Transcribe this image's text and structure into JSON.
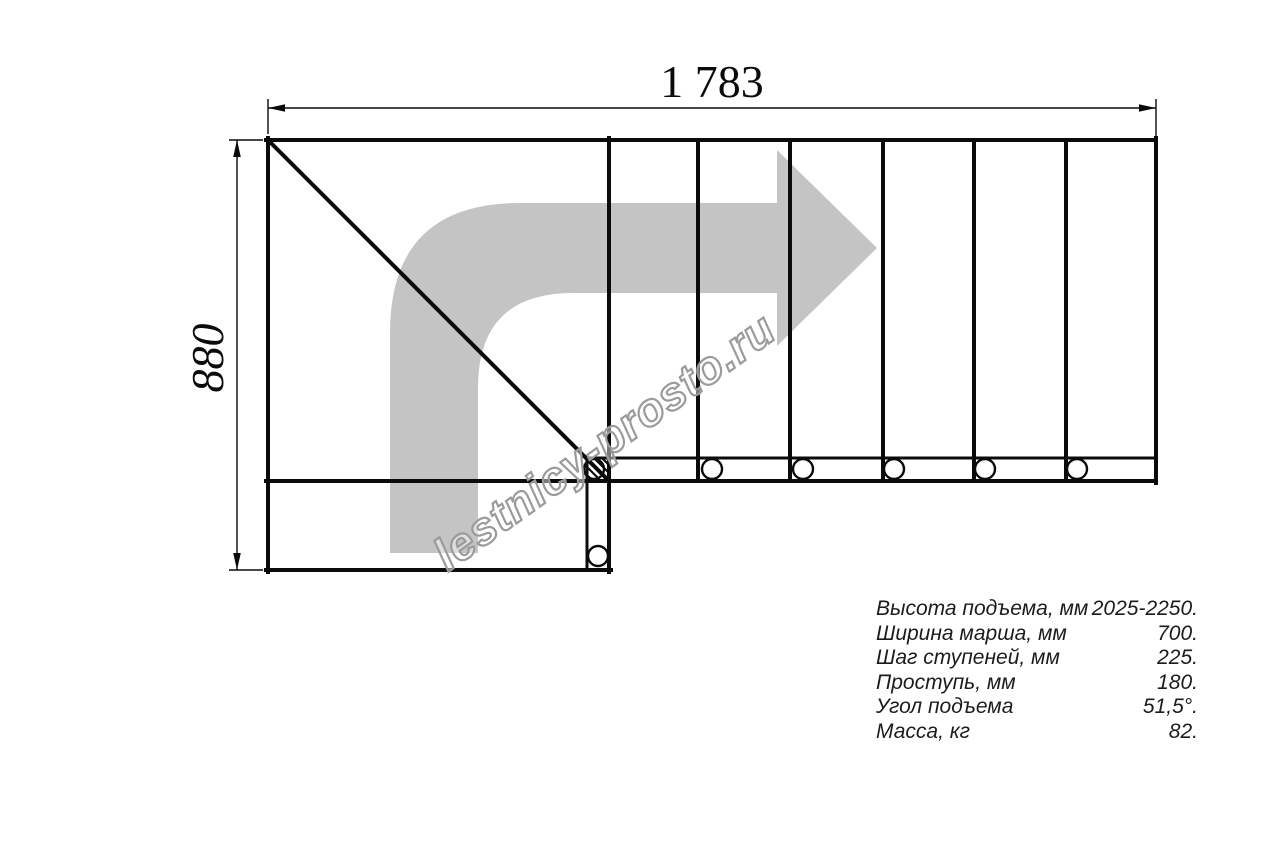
{
  "dimensions": {
    "width_label": "1 783",
    "height_label": "880"
  },
  "watermark": {
    "text": "lestnicy-prosto.ru"
  },
  "specs": {
    "rows": [
      {
        "label": "Высота подъема, мм",
        "value": "2025-2250."
      },
      {
        "label": "Ширина марша, мм",
        "value": "700."
      },
      {
        "label": "Шаг ступеней, мм",
        "value": "225."
      },
      {
        "label": "Проступь, мм",
        "value": "180."
      },
      {
        "label": "Угол подъема",
        "value": "51,5°."
      },
      {
        "label": "Масса, кг",
        "value": "82."
      }
    ]
  },
  "colors": {
    "line": "#0b0b0b",
    "arrow": "#c4c4c4",
    "watermark": "#9b9b9b",
    "text": "#1c1c1c",
    "bg": "#ffffff"
  }
}
